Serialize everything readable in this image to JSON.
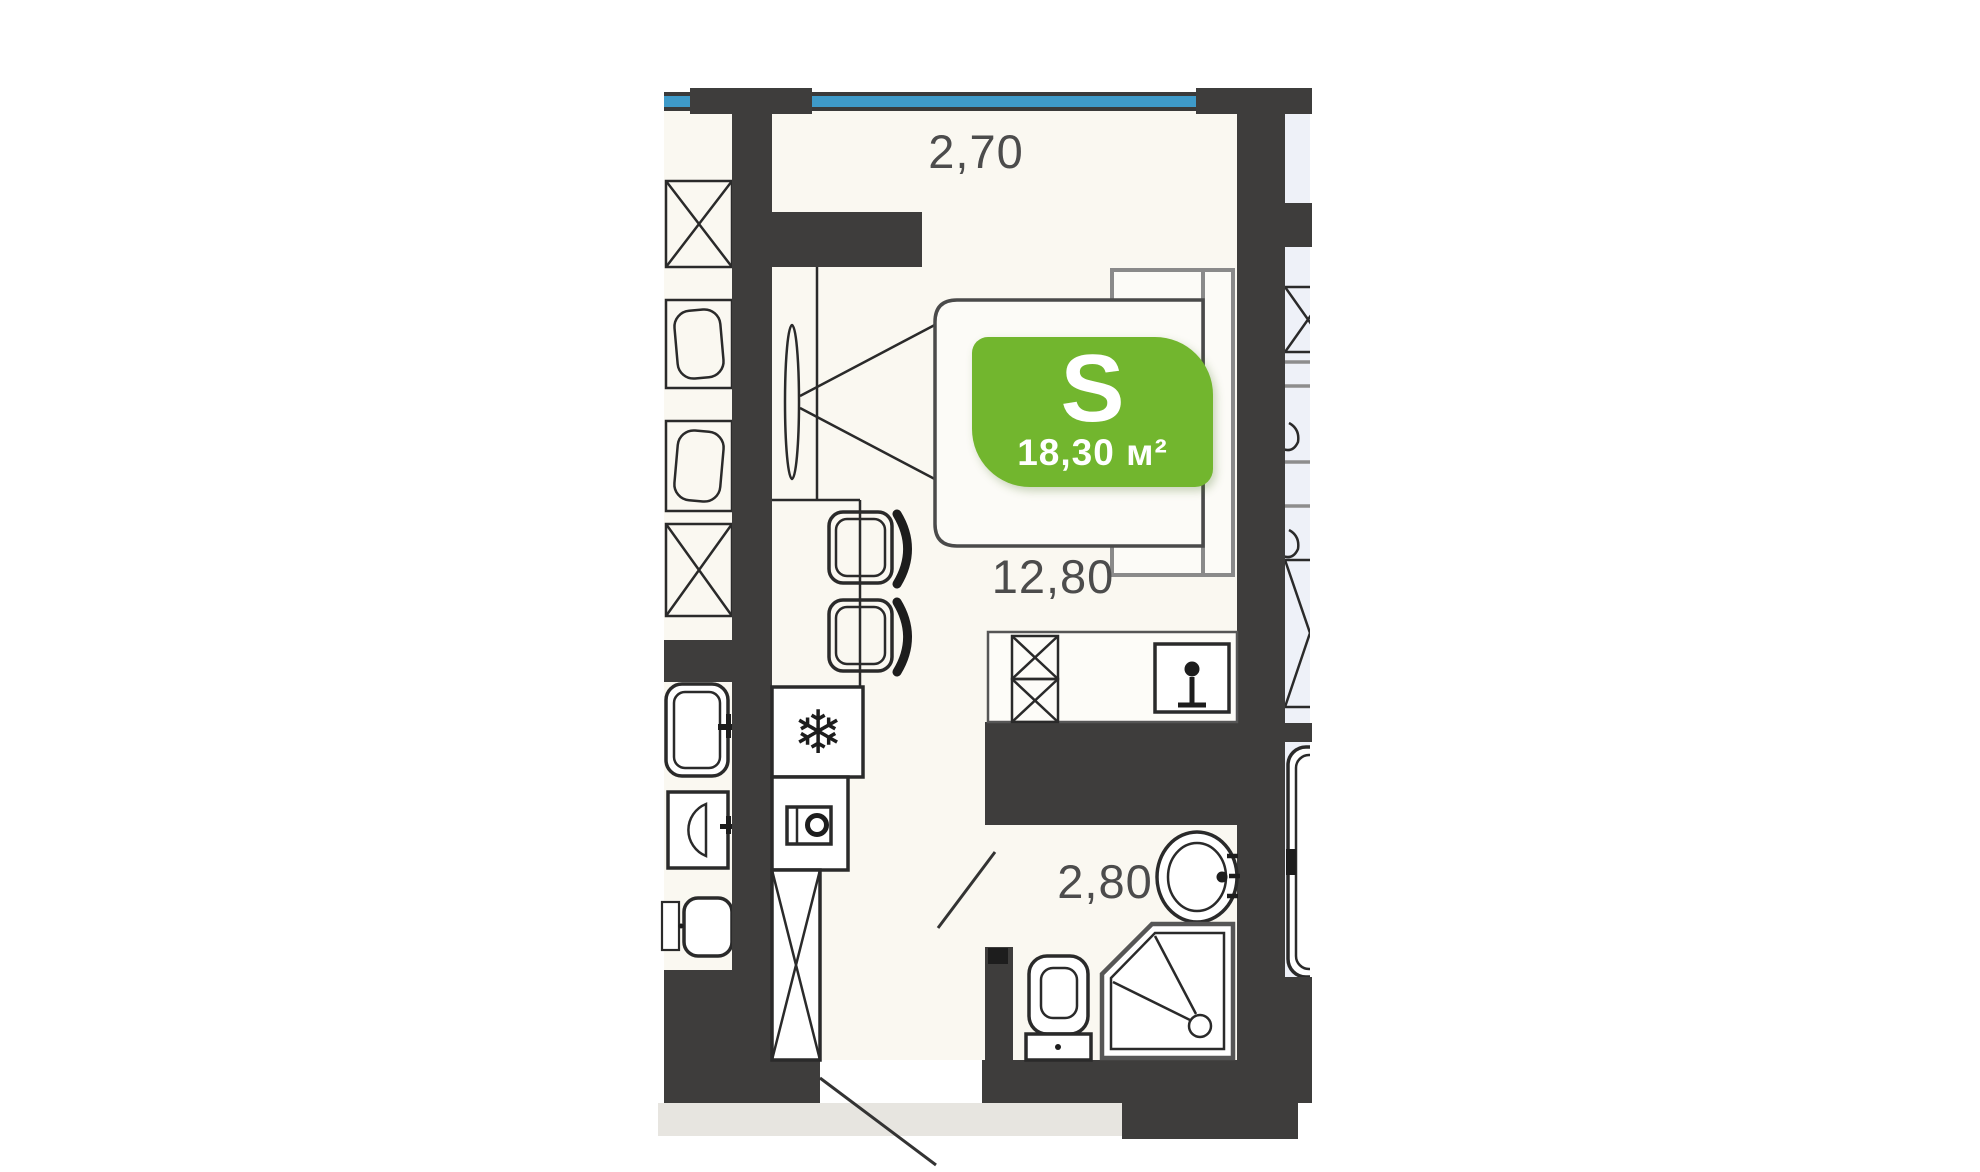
{
  "plan": {
    "area_badge": {
      "label": "S",
      "area": "18,30 м²"
    },
    "dimensions": {
      "top_width": "2,70",
      "room": "12,80",
      "bathroom": "2,80"
    },
    "icons": {
      "fridge": "❄"
    },
    "colors": {
      "wall": "#3e3d3c",
      "floor_unit": "#faf8f1",
      "floor_neighbor": "#eef1f8",
      "window_blue": "#3e9ac9",
      "badge_green": "#72b62e",
      "dim_text": "#4c4c4c",
      "outline": "#2a2a2a",
      "outline_soft": "#8a8a8a",
      "outside_gray": "#e7e5e0"
    }
  }
}
